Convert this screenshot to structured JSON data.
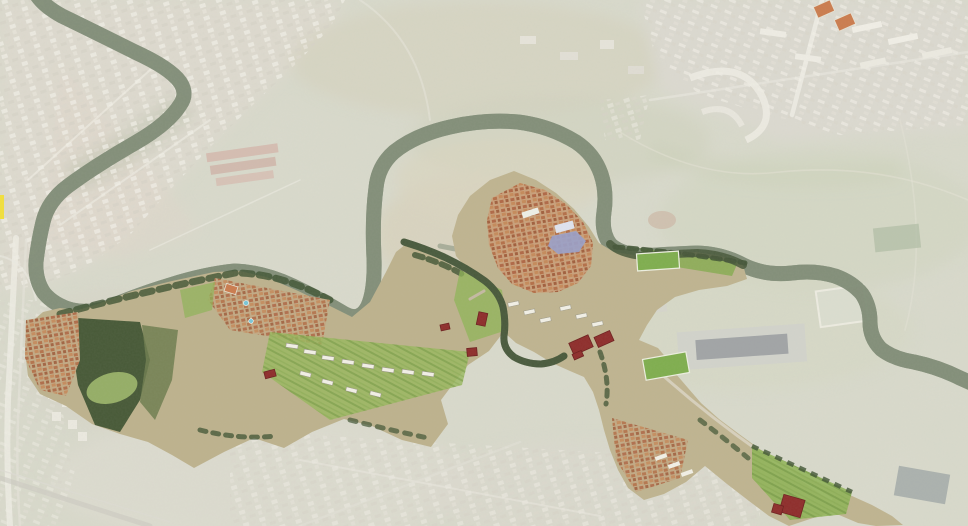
{
  "meta": {
    "title": "Aerial masterplan map of river valley corridor",
    "canvas": {
      "width": 968,
      "height": 526
    },
    "description": "Faded satellite context with saturated masterplan corridor along a meandering tree-lined river; dark red buildings mark plan interventions"
  },
  "palette": {
    "base": "#c9cab7",
    "wash": "#ffffff",
    "river": "#3c4c31",
    "river_fringe": "#55654a",
    "river_saturated": "#47573a",
    "water_light": "#8a9879",
    "city_light": "#e9e6da",
    "city_mid": "#cdc8b8",
    "plan_base_west": "#bdb28d",
    "plan_base_east": "#bfb490",
    "plan_green": "#8fb457",
    "plan_green_bright": "#7fae4e",
    "plan_tree_dark": "#3d5130",
    "olive_wedge": "#6f7c4f",
    "roof_orange": "#b26a42",
    "red_building": "#8e2d2b",
    "red_building_edge": "#6d1f1e",
    "plaza_blue": "#9aa0c8",
    "pool_cyan": "#79c7d8",
    "court_orange": "#cb7c4e",
    "marker_yellow": "#f2e03c",
    "road_light": "#e9e6da",
    "campus_gray": "#c3c2b6",
    "warehouse_dark": "#7f8a86"
  },
  "features": {
    "river": {
      "id": "river-corridor",
      "description": "tree-lined meandering river with double loop and east run"
    },
    "plan_sectors": [
      {
        "id": "west-sector",
        "description": "orchards, borgata, dark grove, slab housing rows"
      },
      {
        "id": "village-and-southeast-sector",
        "description": "historic village core, neck corridor, southeast housing band"
      }
    ],
    "highlight_buildings": [
      {
        "id": "west-orchard-block",
        "x": 270,
        "y": 374,
        "w": 11,
        "h": 7,
        "rot": -15
      },
      {
        "id": "slope-slab-a",
        "x": 482,
        "y": 319,
        "w": 9,
        "h": 13,
        "rot": 12
      },
      {
        "id": "slope-slab-b",
        "x": 472,
        "y": 352,
        "w": 10,
        "h": 8,
        "rot": -5
      },
      {
        "id": "slope-slab-c",
        "x": 445,
        "y": 327,
        "w": 9,
        "h": 6,
        "rot": -12
      },
      {
        "id": "neck-block-west",
        "x": 581,
        "y": 345,
        "w": 21,
        "h": 13,
        "rot": -24,
        "parts": [
          [
            -7,
            8,
            10,
            6
          ]
        ]
      },
      {
        "id": "neck-block-east",
        "x": 604,
        "y": 339,
        "w": 17,
        "h": 11,
        "rot": -24
      },
      {
        "id": "southeast-hall",
        "x": 792,
        "y": 506,
        "w": 22,
        "h": 18,
        "rot": 16,
        "parts": [
          [
            -13,
            7,
            10,
            9
          ]
        ]
      }
    ],
    "pools": [
      {
        "x": 246,
        "y": 303,
        "r": 2.6
      },
      {
        "x": 251,
        "y": 321,
        "r": 2.3
      }
    ],
    "courts": [
      {
        "x": 824,
        "y": 9,
        "w": 18,
        "h": 12,
        "rot": -24
      },
      {
        "x": 845,
        "y": 22,
        "w": 18,
        "h": 12,
        "rot": -24
      },
      {
        "x": 231,
        "y": 289,
        "w": 12,
        "h": 8,
        "rot": 18
      }
    ],
    "sports_fields": [
      {
        "x": 658,
        "y": 261,
        "w": 42,
        "h": 17,
        "rot": -4
      },
      {
        "x": 666,
        "y": 366,
        "w": 44,
        "h": 21,
        "rot": -10
      }
    ],
    "marker": {
      "x": 0,
      "y": 195,
      "w": 4,
      "h": 24
    }
  }
}
